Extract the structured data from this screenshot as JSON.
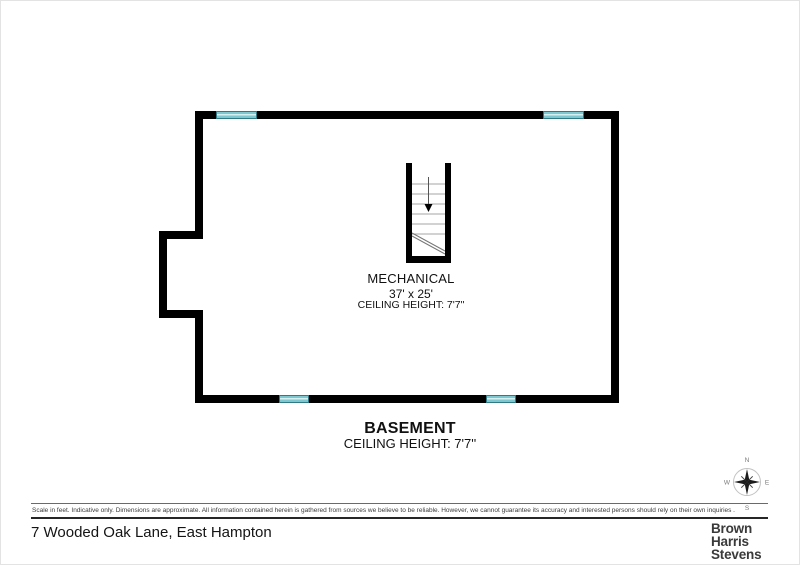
{
  "plan": {
    "room_label": {
      "name": "MECHANICAL",
      "dimensions": "37' x 25'",
      "ceiling_height": "CEILING HEIGHT: 7'7\""
    },
    "floor_label": {
      "name": "BASEMENT",
      "ceiling_height": "CEILING HEIGHT: 7'7''"
    },
    "colors": {
      "wall": "#000000",
      "window_fill": "#7cc7d0",
      "window_border": "#2f7a85"
    },
    "compass": {
      "n": "N",
      "e": "E",
      "s": "S",
      "w": "W"
    }
  },
  "footer": {
    "disclaimer": "Scale in feet. Indicative only. Dimensions are approximate. All information contained herein is gathered from sources we believe to be reliable. However, we cannot guarantee its accuracy and interested persons should rely on their own inquiries .",
    "address": "7 Wooded Oak Lane, East Hampton",
    "brand_lines": [
      "Brown",
      "Harris",
      "Stevens"
    ]
  }
}
